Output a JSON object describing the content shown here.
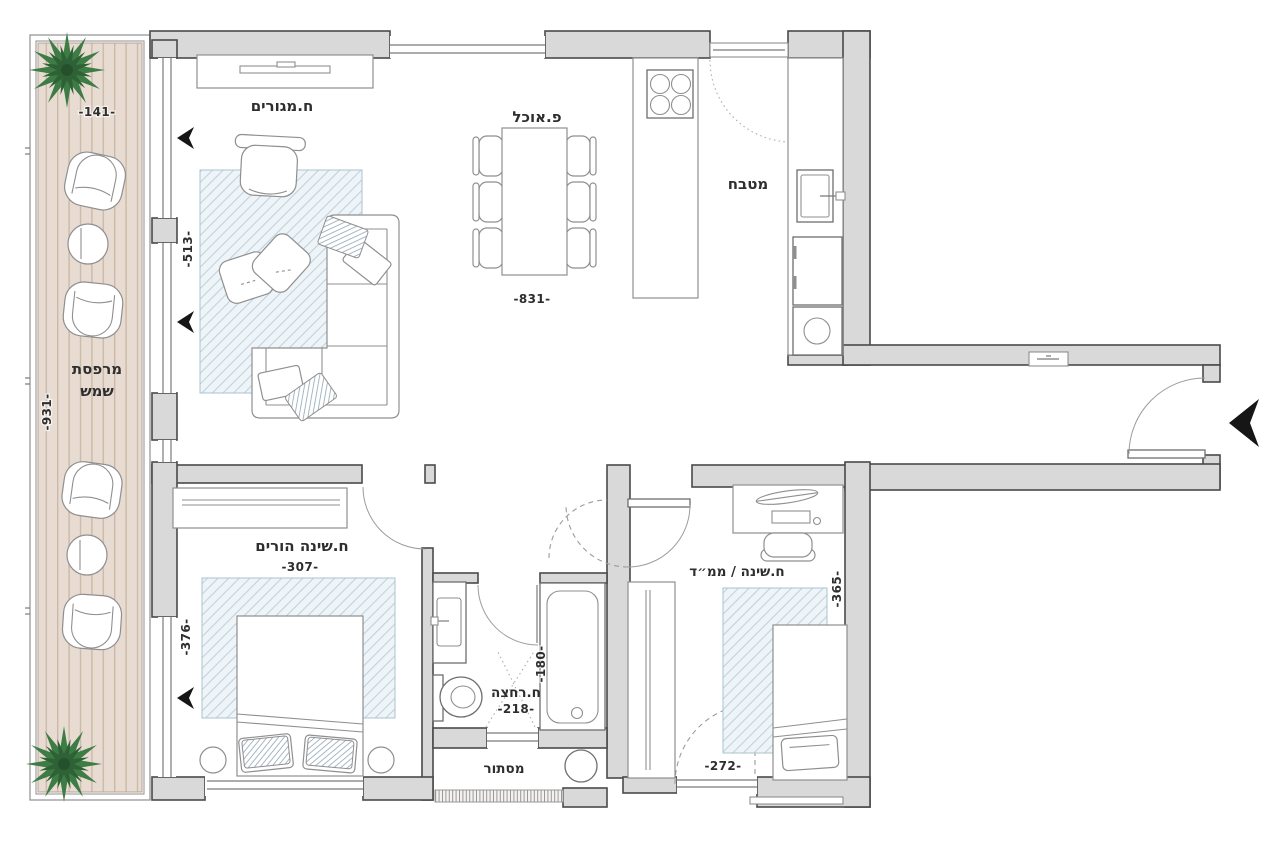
{
  "plan_title": "apartment floor plan",
  "colors": {
    "wall_fill": "#d9d9d9",
    "wall_stroke": "#4a4a4a",
    "deck": "#e8dcd2",
    "deck_stripe": "#cbb9a8",
    "rug_base": "#eef4f7",
    "rug_hatch": "#bdd3de",
    "plant": "#3e7c45",
    "plant_dark": "#2f6136",
    "arrow": "#161616",
    "furniture_stroke": "#8f8f8f",
    "text": "#2e2e2e"
  },
  "rooms": {
    "living": {
      "label": "ח.מגורים",
      "window_dim": "-513-"
    },
    "dining": {
      "label": "פ.אוכל",
      "width_dim": "-831-"
    },
    "kitchen": {
      "label": "מטבח"
    },
    "balcony": {
      "label_line1": "מרפסת",
      "label_line2": "שמש",
      "width_dim": "-141-",
      "length_dim": "-931-"
    },
    "master_bedroom": {
      "label": "ח.שינה הורים",
      "width_dim": "-307-",
      "window_dim": "-376-"
    },
    "bathroom": {
      "label": "ח.רחצה",
      "width_dim": "-218-",
      "depth_dim": "-180-"
    },
    "laundry_niche": {
      "label": "מסתור"
    },
    "safe_room": {
      "label": "ח.שינה / ממ״ד",
      "width_dim": "-272-",
      "depth_dim": "-365-"
    }
  }
}
